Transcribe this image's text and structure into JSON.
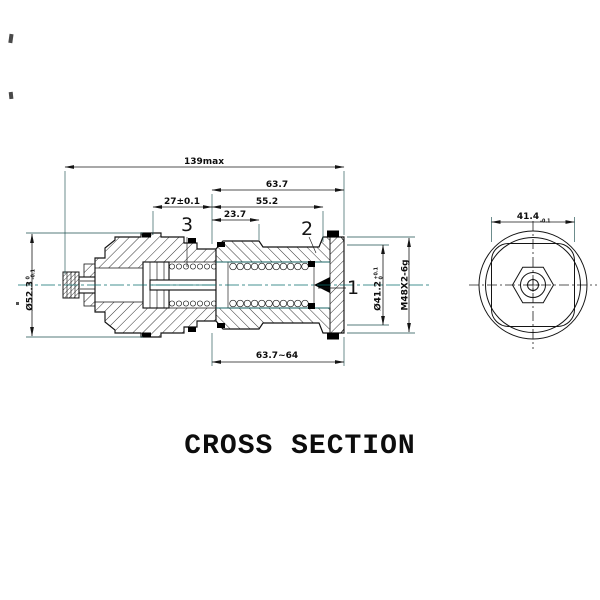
{
  "drawing": {
    "title": "CROSS SECTION",
    "colors": {
      "line": "#141414",
      "accent_teal": "#0a6e6e",
      "background": "#ffffff",
      "seal_fill": "#000000"
    },
    "dimensions": {
      "overall_length": "139max",
      "length_63_7": "63.7",
      "length_55_2": "55.2",
      "length_27": "27±0.1",
      "length_23_7": "23.7",
      "length_63_7_64": "63.7~64",
      "dia_52_3": "Ø52.3",
      "dia_52_3_tol_top": "0",
      "dia_52_3_tol_bot": "-0.1",
      "dia_41_2": "Ø41.2",
      "dia_41_2_tol_top": "+0.1",
      "dia_41_2_tol_bot": "0",
      "thread_spec": "M48X2-6g",
      "end_width": "41.4",
      "end_width_tol": "-0.1"
    },
    "callouts": {
      "part1": "1",
      "part2": "2",
      "part3": "3"
    }
  }
}
